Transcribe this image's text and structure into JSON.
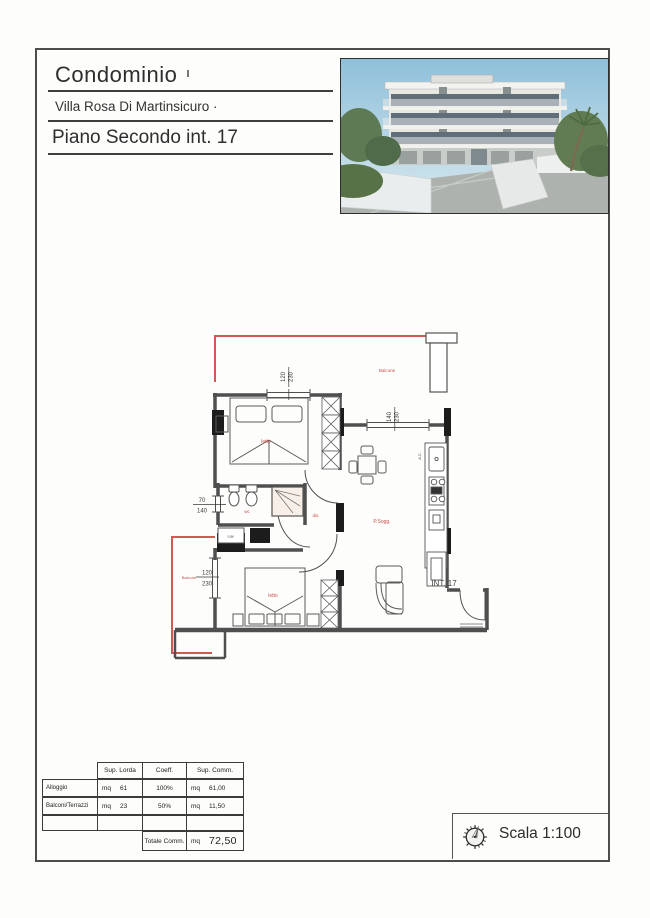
{
  "document": {
    "title": "Condominio",
    "subtitle": "Villa Rosa Di Martinsicuro ·",
    "floor_label": "Piano Secondo int. 17"
  },
  "plan": {
    "rooms": {
      "bedroom_top": "letto",
      "bedroom_bottom": "letto",
      "bathroom": "wc",
      "hallway": "dis.",
      "living": "P.Sogg.",
      "balcony_top": "Balcone",
      "balcony_left": "Balcone"
    },
    "annotations": {
      "unit": "INT. 17",
      "ac": "A.C.",
      "laundry": "Lav."
    },
    "dimensions": {
      "window_top": [
        "120",
        "230"
      ],
      "window_living": [
        "140",
        "230"
      ],
      "window_bath": [
        "70",
        "140"
      ],
      "window_bedroom": [
        "120",
        "230"
      ]
    },
    "colors": {
      "balcony_red": "#cf5a54",
      "wall_gray": "#4f4f4f"
    }
  },
  "table": {
    "col_headers": [
      "Sup. Lorda",
      "Coeff.",
      "Sup. Comm."
    ],
    "rows": [
      {
        "label": "Alloggio",
        "unit_a": "mq",
        "lorda": "61",
        "coeff": "100%",
        "unit_b": "mq",
        "comm": "61,00"
      },
      {
        "label": "Balconi/Terrazzi",
        "unit_a": "mq",
        "lorda": "23",
        "coeff": "50%",
        "unit_b": "mq",
        "comm": "11,50"
      }
    ],
    "total": {
      "label": "Totale Comm.",
      "unit": "mq",
      "value": "72,50"
    }
  },
  "footer": {
    "scale": "Scala 1:100"
  }
}
